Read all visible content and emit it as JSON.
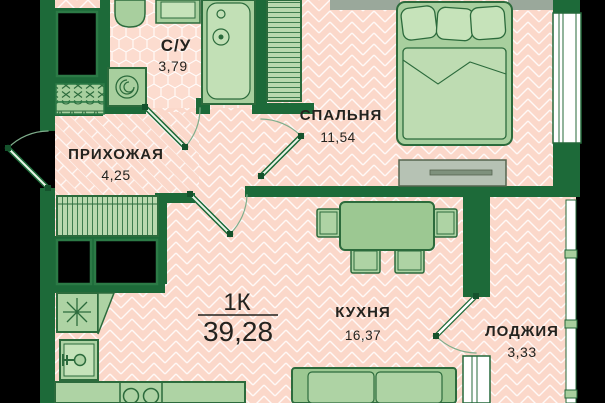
{
  "plan": {
    "type_label": "1К",
    "total_area": "39,28",
    "rooms": [
      {
        "id": "bathroom",
        "name": "С/У",
        "area": "3,79"
      },
      {
        "id": "hallway",
        "name": "ПРИХОЖАЯ",
        "area": "4,25"
      },
      {
        "id": "bedroom",
        "name": "СПАЛЬНЯ",
        "area": "11,54"
      },
      {
        "id": "kitchen",
        "name": "КУХНЯ",
        "area": "16,37"
      },
      {
        "id": "loggia",
        "name": "ЛОДЖИЯ",
        "area": "3,33"
      }
    ],
    "colors": {
      "wall": "#1d6a39",
      "floor": "#fbd8ca",
      "pattern_line": "#ffffff",
      "fixture": "#a8cf9e",
      "fixture_light": "#c6e3ba",
      "furniture": "#9cc892",
      "grey_wall": "#9aa89b",
      "outside": "#000000",
      "text": "#23231f"
    }
  }
}
